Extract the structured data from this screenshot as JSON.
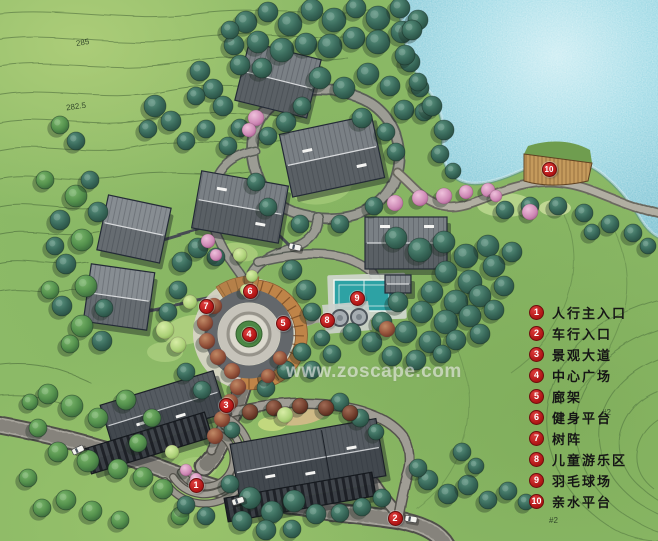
{
  "watermark": "www.zoscape.com",
  "legend": {
    "items": [
      {
        "num": "1",
        "label": "人行主入口"
      },
      {
        "num": "2",
        "label": "车行入口"
      },
      {
        "num": "3",
        "label": "景观大道"
      },
      {
        "num": "4",
        "label": "中心广场"
      },
      {
        "num": "5",
        "label": "廊架"
      },
      {
        "num": "6",
        "label": "健身平台"
      },
      {
        "num": "7",
        "label": "树阵"
      },
      {
        "num": "8",
        "label": "儿童游乐区"
      },
      {
        "num": "9",
        "label": "羽毛球场"
      },
      {
        "num": "10",
        "label": "亲水平台"
      }
    ]
  },
  "map": {
    "markers": [
      {
        "num": "1",
        "x": 196,
        "y": 485
      },
      {
        "num": "2",
        "x": 395,
        "y": 518
      },
      {
        "num": "3",
        "x": 226,
        "y": 405
      },
      {
        "num": "4",
        "x": 249,
        "y": 334
      },
      {
        "num": "5",
        "x": 283,
        "y": 323
      },
      {
        "num": "6",
        "x": 250,
        "y": 291
      },
      {
        "num": "7",
        "x": 206,
        "y": 306
      },
      {
        "num": "8",
        "x": 327,
        "y": 320
      },
      {
        "num": "9",
        "x": 357,
        "y": 298
      },
      {
        "num": "10",
        "x": 549,
        "y": 169
      }
    ],
    "contour_labels": [
      {
        "text": "285",
        "x": 76,
        "y": 38,
        "rot": -10
      },
      {
        "text": "282.5",
        "x": 66,
        "y": 102,
        "rot": -8
      },
      {
        "text": "#2",
        "x": 602,
        "y": 408,
        "rot": 0
      },
      {
        "text": "#2",
        "x": 549,
        "y": 516,
        "rot": 0
      }
    ]
  },
  "colors": {
    "marker_red": "#b81d1d",
    "lake": "#9ed8e3",
    "grass": "#8cba67",
    "road": "#9c9c94",
    "roof_gray": "#70767b",
    "court_teal": "#2da2a4",
    "deck_tan": "#c49a5c",
    "pergola_tan": "#bf8448",
    "tree_dark": "#2f5f54",
    "tree_red": "#9c5a42"
  }
}
